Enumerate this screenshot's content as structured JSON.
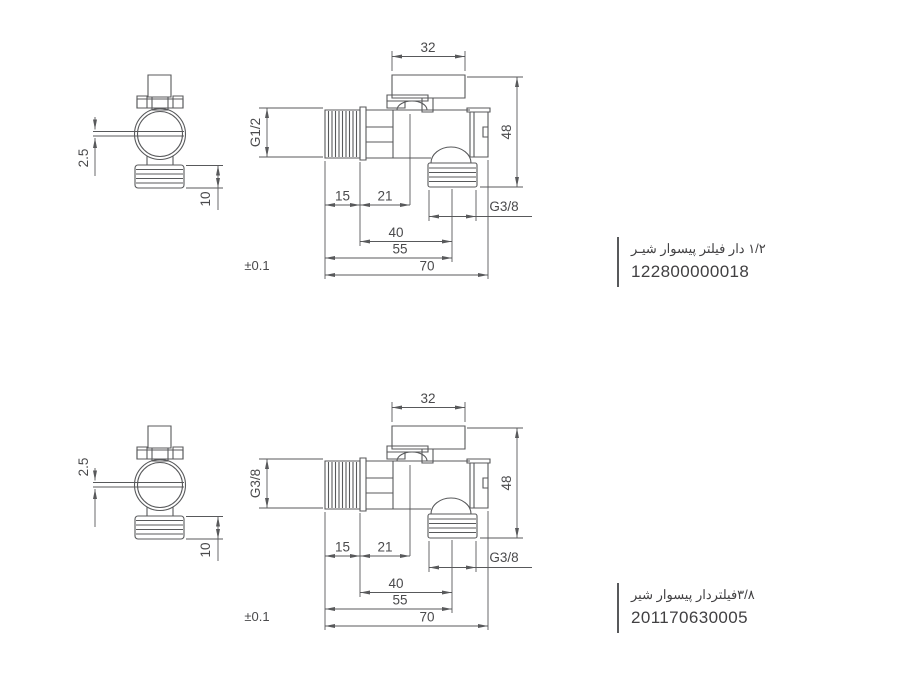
{
  "page": {
    "background": "#ffffff"
  },
  "sections": [
    {
      "product": {
        "title": "۱/۲ دار فیلتر پیسوار شیـر",
        "code": "122800000018"
      },
      "dims": {
        "handle_width": "32",
        "body_height": "48",
        "inlet_thread": "G1/2",
        "inlet_len": "15",
        "body_len": "21",
        "outlet_thread": "G3/8",
        "outlet_offset": "40",
        "len_mid": "55",
        "total_len": "70",
        "tolerance": "±0.1",
        "slot_width": "2.5",
        "thread_len": "10"
      }
    },
    {
      "product": {
        "title": "۳/۸فیلتردار پیسوار شیر",
        "code": "201170630005"
      },
      "dims": {
        "handle_width": "32",
        "body_height": "48",
        "inlet_thread": "G3/8",
        "inlet_len": "15",
        "body_len": "21",
        "outlet_thread": "G3/8",
        "outlet_offset": "40",
        "len_mid": "55",
        "total_len": "70",
        "tolerance": "±0.1",
        "slot_width": "2.5",
        "thread_len": "10"
      }
    }
  ],
  "colors": {
    "line": "#58595b",
    "dim_text": "#4a4a4c",
    "label_text": "#414042",
    "divider_thick": "#221e1f",
    "divider_thin": "#3b3b3b"
  }
}
